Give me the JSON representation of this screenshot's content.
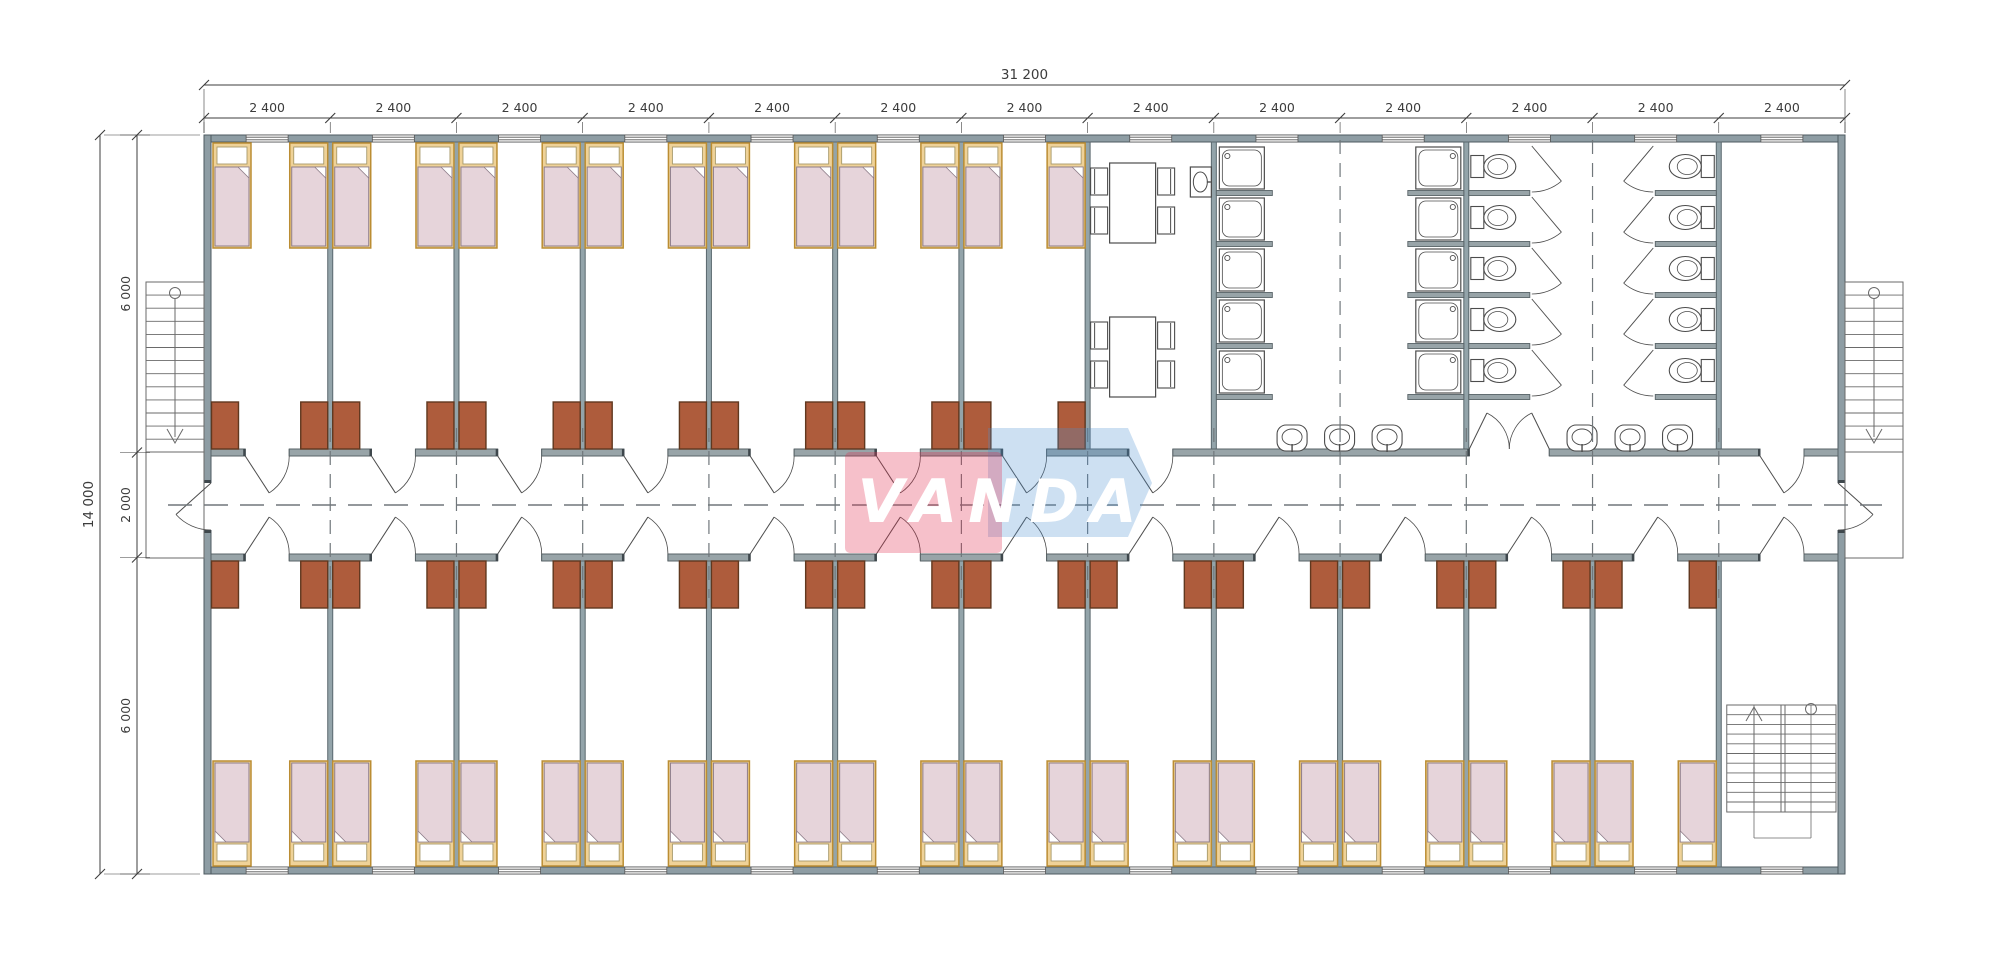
{
  "logo": {
    "text": "VANDA",
    "red_color": "#e03050",
    "red_opacity": 0.3,
    "blue_color": "#4a90d0",
    "blue_opacity": 0.28,
    "text_color": "#ffffff"
  },
  "dimensions": {
    "total_width": "31 200",
    "bay_width": "2 400",
    "bay_count": 13,
    "total_height": "14 000",
    "upper_rooms_depth": "6 000",
    "corridor_width": "2 000",
    "lower_rooms_depth": "6 000"
  },
  "inventory": {
    "bedrooms_top": 7,
    "bedrooms_bottom": 12,
    "beds": 38,
    "desks": 38,
    "dining_tables": 2,
    "dining_chairs": 8,
    "shower_stalls": 10,
    "toilet_stalls": 10,
    "wash_basins": 7,
    "exterior_staircases": 2,
    "interior_staircases": 1
  },
  "colors": {
    "wall_fill": "#8e9da4",
    "wall_stroke": "#4e5a60",
    "partition_fill": "#93a4aa",
    "partition_stroke": "#5a686e",
    "corridor_wall_fill": "#98a4a8",
    "corridor_wall_stroke": "#586367",
    "jamb_cap": "#3e474c",
    "bed_frame_fill": "#efd298",
    "bed_frame_stroke": "#bb8d33",
    "pillow_fill": "#ffffff",
    "pillow_stroke": "#a89a6a",
    "blanket_fill": "#e6d4da",
    "blanket_stroke": "#8e7d89",
    "desk_fill": "#ae5c3c",
    "desk_stroke": "#60381f",
    "fixture_stroke": "#4c4c4c",
    "stair_stroke": "#6a6a6a",
    "dash_stroke": "#70777b",
    "dimension_color": "#3c3c3c",
    "window_stroke": "#555555"
  },
  "geometry": {
    "left": 204,
    "right": 1845,
    "top": 135,
    "bottom": 874,
    "corridor_wall_top": 449,
    "corridor_wall_bottom": 554,
    "wall_thickness": 7,
    "partition_thickness": 5,
    "door_opening": 44,
    "window_width": 42,
    "bed_w": 38,
    "bed_l": 105,
    "desk_w": 27,
    "desk_l": 47
  }
}
